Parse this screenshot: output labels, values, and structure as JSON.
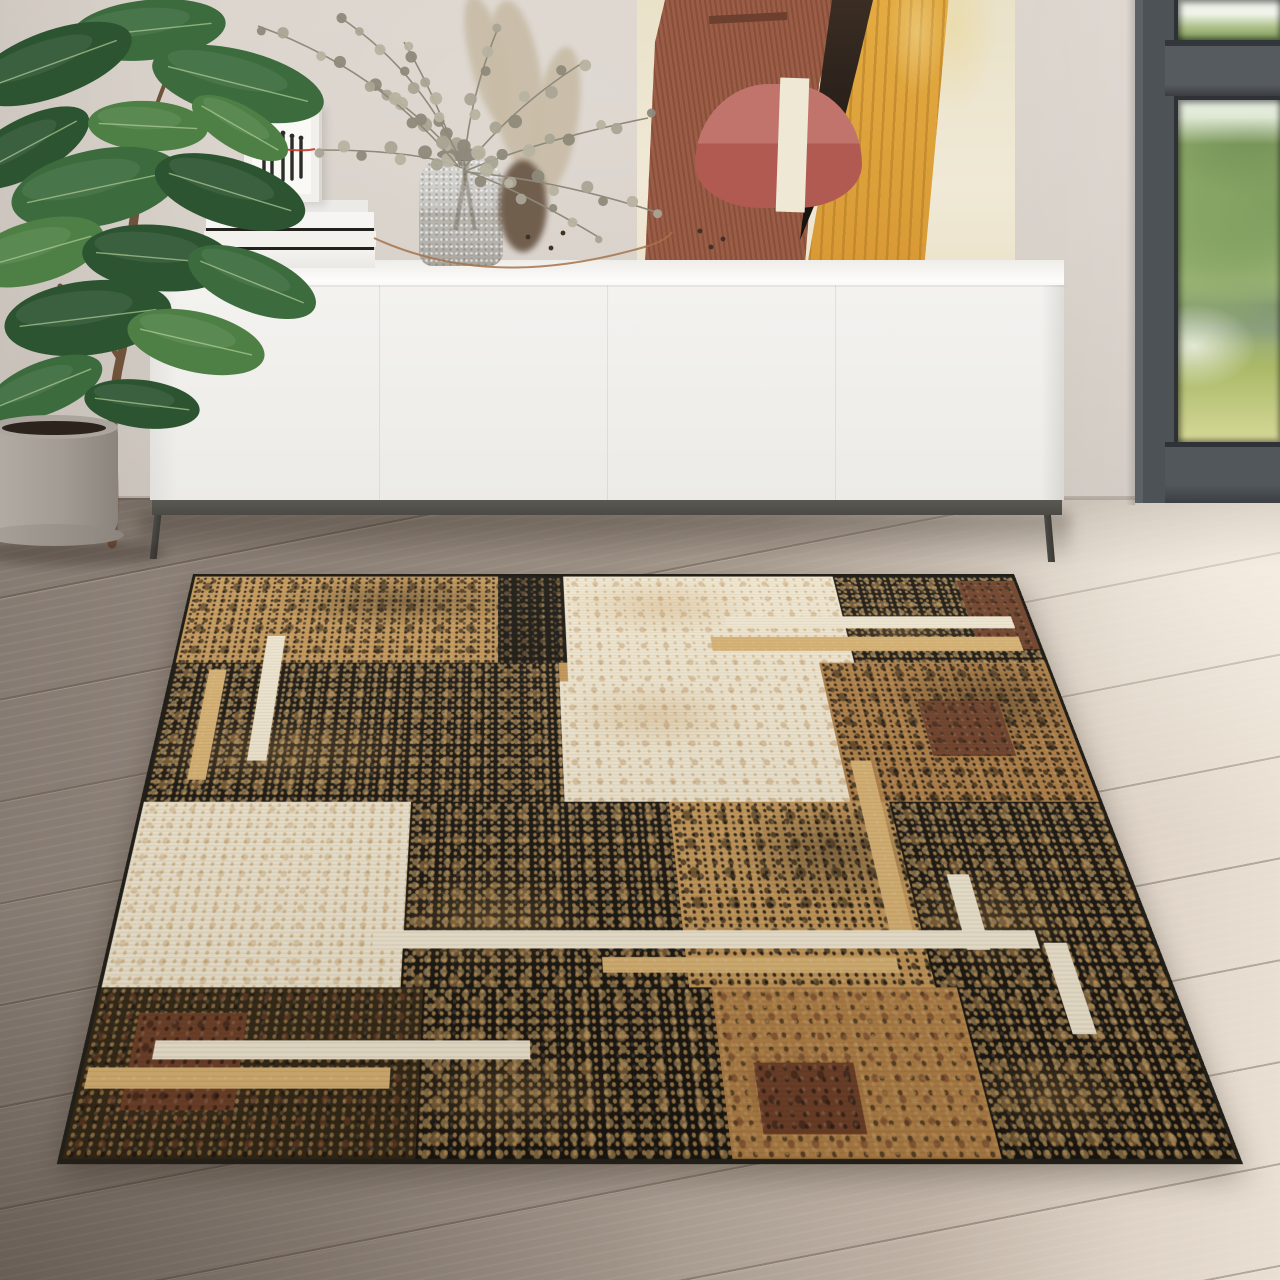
{
  "scene": {
    "kind": "interior lifestyle photo of a patchwork area rug",
    "objects": [
      "potted-rubber-plant",
      "white-sideboard",
      "book-stack",
      "framed-sketch",
      "glass-vase",
      "dried-eucalyptus-bouquet",
      "pampas-plumes",
      "abstract-painting",
      "garden-window",
      "wood-floor",
      "patchwork-rug"
    ]
  },
  "palette": {
    "wall": "#d7d0c8",
    "frame": "#4d5257",
    "frameDark": "#2e3236",
    "floorLeft": "#867b72",
    "floorRight": "#e9dfd2",
    "plankLine": "#5f5349",
    "cabinet": "#f2f1ee",
    "plinth": "#55534d",
    "leg": "#45433f",
    "canvasCream": "#ece4cd",
    "rust": "#9a5d47",
    "mustard": "#dfa63e",
    "potRose": "#c1746c",
    "trunkDark": "#241b14",
    "bandCream": "#efe8d5",
    "plantTrunk": "#70513a",
    "plantVein": "#b9d49c",
    "potGrey": "#a49e97",
    "soil": "#2b231c",
    "euc": "#a9a493",
    "eucDark": "#8e897a",
    "eucLight": "#b7b2a0",
    "pampas": "#c8bca6",
    "cluster": "#63503c",
    "wire": "#a3734b",
    "seed": "#3e3226",
    "glass": "#ccccc8",
    "ink": "#2c2c28",
    "red": "#c23b2e",
    "rugTan": "#c49758",
    "rugTanDark": "#b07f46",
    "rugTanLight": "#d8b272",
    "rugBlack": "#181510",
    "rugCream": "#f0e7d1",
    "rugMaroon": "#6f4028",
    "rugBind": "#221f19",
    "leafA": "#3c6b3d",
    "leafB": "#2d5431",
    "leafC": "#4e8045"
  },
  "rug": {
    "patches": [
      {
        "x": 0,
        "y": 0,
        "w": 37,
        "h": 20,
        "cls": "p-tan tx-bheavy"
      },
      {
        "x": 37,
        "y": 0,
        "w": 8,
        "h": 20,
        "cls": "p-black tx-tan"
      },
      {
        "x": 45,
        "y": 0,
        "w": 33,
        "h": 24,
        "cls": "p-cream tx-tanlight"
      },
      {
        "x": 78,
        "y": 0,
        "w": 22,
        "h": 20,
        "cls": "p-black tx-tanheavy"
      },
      {
        "x": 93,
        "y": 1,
        "w": 7,
        "h": 16,
        "cls": "p-maroon tx-black"
      },
      {
        "x": 0,
        "y": 20,
        "w": 44,
        "h": 27.5,
        "cls": "p-black tx-tanheavy"
      },
      {
        "x": 44,
        "y": 24,
        "w": 30,
        "h": 23.5,
        "cls": "p-cream tx-tanlight"
      },
      {
        "x": 74,
        "y": 20,
        "w": 26,
        "h": 27.5,
        "cls": "p-tandark tx-bheavy"
      },
      {
        "x": 84,
        "y": 28,
        "w": 9,
        "h": 11,
        "cls": "p-maroon tx-black"
      },
      {
        "x": 0,
        "y": 47.5,
        "w": 28,
        "h": 30,
        "cls": "p-cream tx-tan"
      },
      {
        "x": 28,
        "y": 47.5,
        "w": 27,
        "h": 30,
        "cls": "p-black tx-tanheavy"
      },
      {
        "x": 55,
        "y": 47.5,
        "w": 23,
        "h": 30,
        "cls": "p-tan tx-bheavy"
      },
      {
        "x": 78,
        "y": 47.5,
        "w": 22,
        "h": 30,
        "cls": "p-black tx-tanheavy"
      },
      {
        "x": 0,
        "y": 77.5,
        "w": 30,
        "h": 22.5,
        "cls": "p-blacktan tx-maroon"
      },
      {
        "x": 30,
        "y": 77.5,
        "w": 27,
        "h": 22.5,
        "cls": "p-black tx-tanheavy"
      },
      {
        "x": 57,
        "y": 77.5,
        "w": 23,
        "h": 22.5,
        "cls": "p-tandark tx-maroon"
      },
      {
        "x": 80,
        "y": 77.5,
        "w": 20,
        "h": 22.5,
        "cls": "p-black tx-tanheavy"
      },
      {
        "x": 4,
        "y": 81,
        "w": 10,
        "h": 13,
        "cls": "p-maroon tx-black"
      },
      {
        "x": 60,
        "y": 88,
        "w": 9,
        "h": 9,
        "cls": "p-maroon tx-black"
      }
    ],
    "accents": [
      {
        "x": 64,
        "y": 9.5,
        "w": 34,
        "h": 2.8,
        "tone": "cream"
      },
      {
        "x": 62,
        "y": 14.3,
        "w": 36,
        "h": 3.2,
        "tone": "tanlight"
      },
      {
        "x": 10,
        "y": 14,
        "w": 2.2,
        "h": 26,
        "tone": "cream"
      },
      {
        "x": 4,
        "y": 21.5,
        "w": 2,
        "h": 22,
        "tone": "tanlight"
      },
      {
        "x": 75,
        "y": 40,
        "w": 2.2,
        "h": 29,
        "tone": "tanlight"
      },
      {
        "x": 82,
        "y": 60,
        "w": 2.2,
        "h": 12,
        "tone": "cream"
      },
      {
        "x": 89.5,
        "y": 71,
        "w": 2.2,
        "h": 13,
        "tone": "cream"
      },
      {
        "x": 25,
        "y": 69,
        "w": 64,
        "h": 2.8,
        "tone": "cream"
      },
      {
        "x": 47,
        "y": 73,
        "w": 28,
        "h": 2.4,
        "tone": "tanlight"
      },
      {
        "x": 6,
        "y": 85,
        "w": 34,
        "h": 2.5,
        "tone": "cream"
      },
      {
        "x": 0.5,
        "y": 88.5,
        "w": 27,
        "h": 2.8,
        "tone": "tanlight"
      }
    ]
  },
  "plant": {
    "leaves": [
      {
        "cx": 148,
        "cy": 30,
        "rx": 78,
        "ry": 30,
        "rot": -6,
        "tone": "leafA"
      },
      {
        "cx": 52,
        "cy": 64,
        "rx": 84,
        "ry": 33,
        "rot": -20,
        "tone": "leafB"
      },
      {
        "cx": 238,
        "cy": 84,
        "rx": 88,
        "ry": 34,
        "rot": 14,
        "tone": "leafA"
      },
      {
        "cx": 26,
        "cy": 148,
        "rx": 70,
        "ry": 29,
        "rot": -28,
        "tone": "leafB"
      },
      {
        "cx": 148,
        "cy": 126,
        "rx": 60,
        "ry": 25,
        "rot": 3,
        "tone": "leafC"
      },
      {
        "cx": 240,
        "cy": 128,
        "rx": 54,
        "ry": 22,
        "rot": 30,
        "tone": "leafC"
      },
      {
        "cx": 96,
        "cy": 188,
        "rx": 86,
        "ry": 38,
        "rot": -12,
        "tone": "leafA"
      },
      {
        "cx": 230,
        "cy": 192,
        "rx": 78,
        "ry": 33,
        "rot": 17,
        "tone": "leafB"
      },
      {
        "cx": 36,
        "cy": 252,
        "rx": 70,
        "ry": 31,
        "rot": -16,
        "tone": "leafC"
      },
      {
        "cx": 158,
        "cy": 258,
        "rx": 76,
        "ry": 33,
        "rot": 5,
        "tone": "leafB"
      },
      {
        "cx": 252,
        "cy": 282,
        "rx": 68,
        "ry": 29,
        "rot": 22,
        "tone": "leafA"
      },
      {
        "cx": 88,
        "cy": 318,
        "rx": 84,
        "ry": 37,
        "rot": -7,
        "tone": "leafB"
      },
      {
        "cx": 196,
        "cy": 342,
        "rx": 70,
        "ry": 30,
        "rot": 13,
        "tone": "leafC"
      },
      {
        "cx": 44,
        "cy": 388,
        "rx": 62,
        "ry": 26,
        "rot": -22,
        "tone": "leafA"
      },
      {
        "cx": 142,
        "cy": 404,
        "rx": 58,
        "ry": 24,
        "rot": 7,
        "tone": "leafB"
      }
    ],
    "trunk": [
      {
        "d": "M112,544 C118,470 106,420 120,360 C132,310 126,250 138,196 C144,168 150,140 152,118",
        "w": 9
      },
      {
        "d": "M120,360 C100,330 84,300 60,286",
        "w": 5
      },
      {
        "d": "M138,196 C120,180 108,168 92,160",
        "w": 5
      },
      {
        "d": "M152,118 C160,96 168,70 182,54",
        "w": 4
      },
      {
        "d": "M138,196 C156,186 170,176 196,172",
        "w": 4
      }
    ]
  },
  "bouquet": {
    "branches": [
      {
        "p": [
          462,
          166,
          430,
          120,
          372,
          84
        ],
        "n": 7,
        "r": 7
      },
      {
        "p": [
          462,
          168,
          420,
          150,
          318,
          150
        ],
        "n": 8,
        "r": 6.5
      },
      {
        "p": [
          460,
          166,
          436,
          96,
          404,
          42
        ],
        "n": 6,
        "r": 6
      },
      {
        "p": [
          464,
          164,
          470,
          96,
          498,
          28
        ],
        "n": 6,
        "r": 6
      },
      {
        "p": [
          466,
          166,
          516,
          104,
          584,
          62
        ],
        "n": 7,
        "r": 6.5
      },
      {
        "p": [
          468,
          170,
          540,
          140,
          648,
          118
        ],
        "n": 8,
        "r": 6
      },
      {
        "p": [
          462,
          164,
          420,
          70,
          338,
          16
        ],
        "n": 7,
        "r": 5.5
      },
      {
        "p": [
          466,
          172,
          556,
          180,
          656,
          212
        ],
        "n": 8,
        "r": 6
      },
      {
        "p": [
          458,
          166,
          380,
          70,
          258,
          26
        ],
        "n": 8,
        "r": 6
      },
      {
        "p": [
          464,
          170,
          520,
          190,
          600,
          238
        ],
        "n": 6,
        "r": 5
      }
    ],
    "plumes": [
      {
        "cx": 516,
        "cy": 84,
        "rx": 26,
        "ry": 84,
        "rot": -7
      },
      {
        "cx": 556,
        "cy": 120,
        "rx": 22,
        "ry": 74,
        "rot": 9
      },
      {
        "cx": 488,
        "cy": 60,
        "rx": 18,
        "ry": 66,
        "rot": -14
      }
    ],
    "cluster": {
      "cx": 523,
      "cy": 206,
      "rx": 24,
      "ry": 46
    },
    "wire": "M374,238 C470,282 566,270 648,246 C660,242 668,238 672,232",
    "seeds": [
      [
        528,
        237
      ],
      [
        551,
        248
      ],
      [
        563,
        233
      ],
      [
        700,
        231
      ],
      [
        723,
        239
      ],
      [
        711,
        247
      ]
    ]
  },
  "print_art": {
    "strokes": [
      [
        264,
        140,
        178
      ],
      [
        272,
        137,
        180
      ],
      [
        283,
        136,
        180
      ],
      [
        292,
        139,
        179
      ],
      [
        301,
        141,
        177
      ]
    ],
    "red_path": "M260,151 C276,146 298,153 315,149"
  }
}
